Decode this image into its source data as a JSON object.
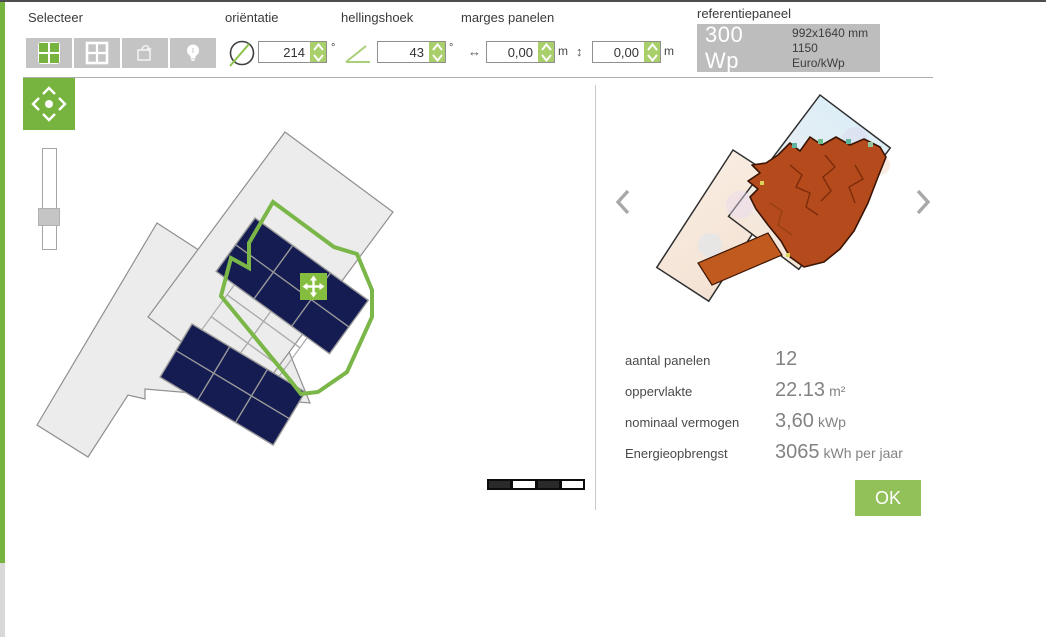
{
  "colors": {
    "accent_green": "#76b33f",
    "ok_green": "#93c159",
    "spinner_green": "#a9cf6b",
    "outline_green": "#7ab648",
    "panel_navy": "#141c52",
    "building_gray": "#ececec",
    "heat_red": "#b54a1c"
  },
  "toolbar": {
    "select": {
      "label": "Selecteer"
    },
    "orientation": {
      "label": "oriëntatie",
      "value": "214",
      "unit": "°"
    },
    "tilt": {
      "label": "hellingshoek",
      "value": "43",
      "unit": "°"
    },
    "margins": {
      "label": "marges panelen",
      "horizontal": {
        "value": "0,00",
        "unit": "m"
      },
      "vertical": {
        "value": "0,00",
        "unit": "m"
      }
    },
    "reference_panel": {
      "label": "referentiepaneel",
      "power": "300 Wp",
      "size": "992x1640 mm",
      "price": "1150 Euro/kWp"
    }
  },
  "icons": {
    "margin_horizontal": "↔",
    "margin_vertical": "↕"
  },
  "stats": {
    "rows": [
      {
        "label": "aantal panelen",
        "value": "12",
        "unit": ""
      },
      {
        "label": "oppervlakte",
        "value": "22.13",
        "unit": "m²"
      },
      {
        "label": "nominaal vermogen",
        "value": "3,60",
        "unit": "kWp"
      },
      {
        "label": "Energieopbrengst",
        "value": "3065",
        "unit": "kWh per jaar"
      }
    ]
  },
  "actions": {
    "ok": "OK"
  }
}
